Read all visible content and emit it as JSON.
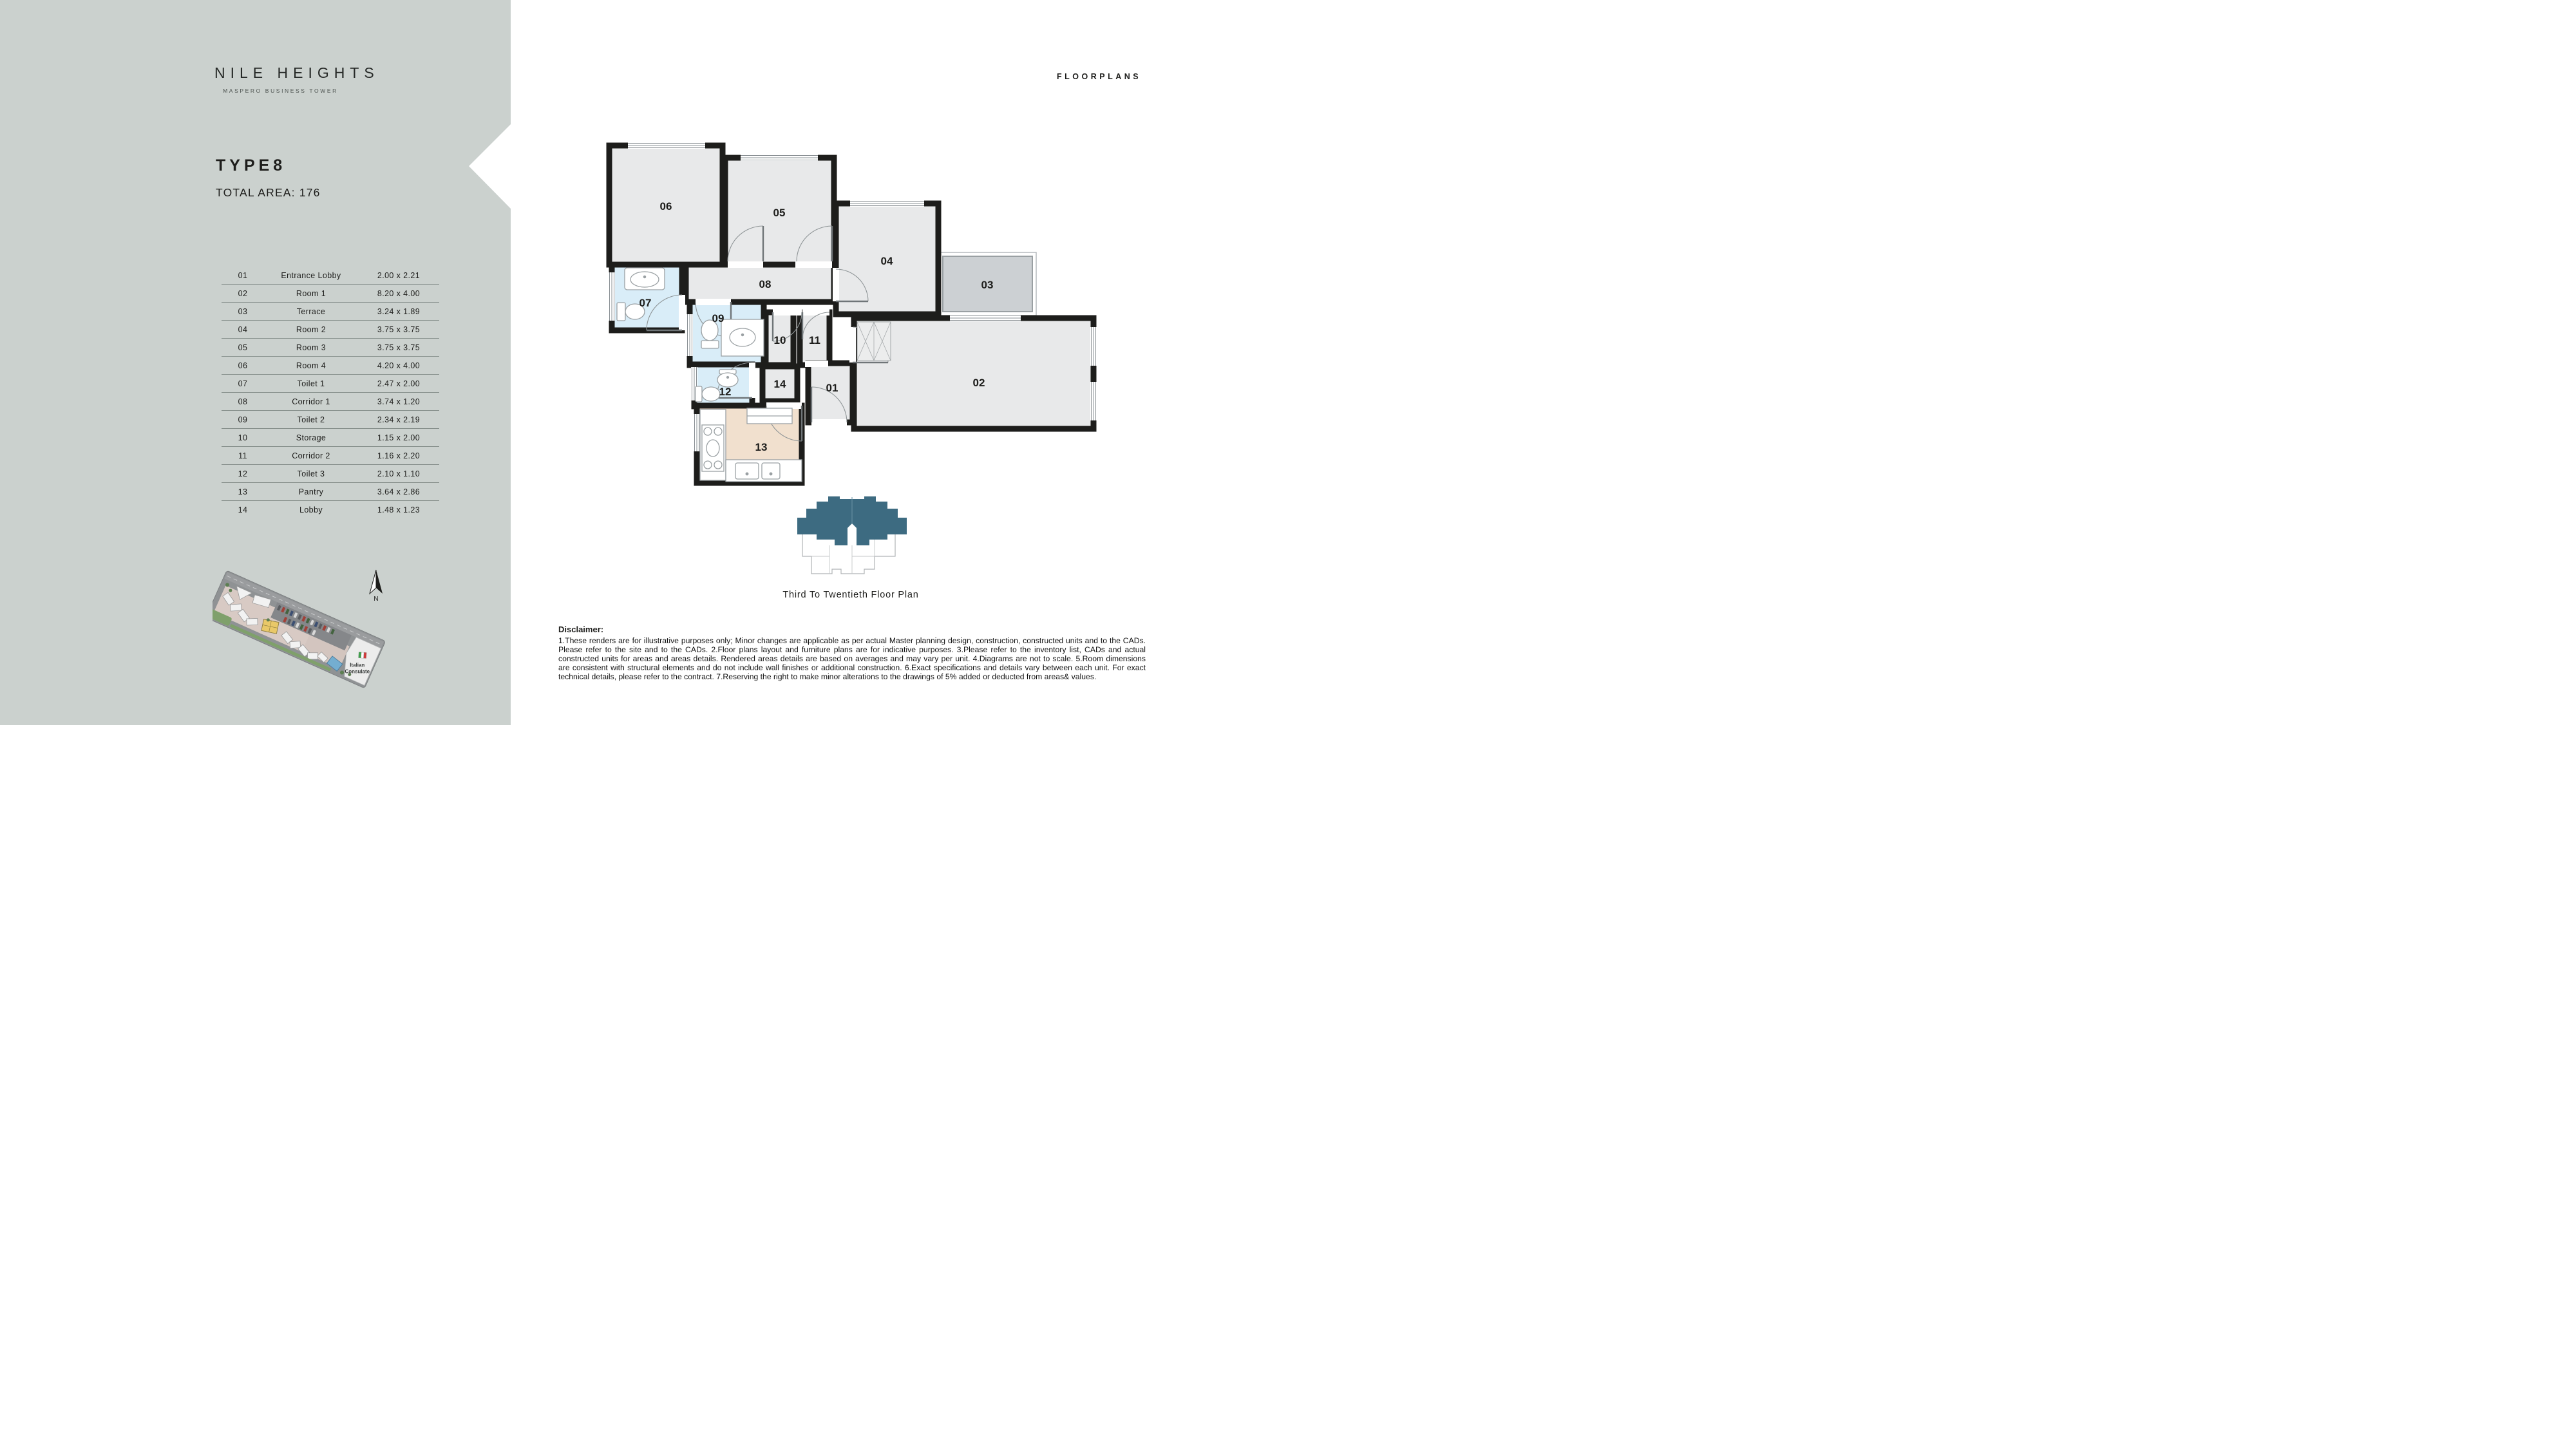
{
  "brand": {
    "title": "NILE HEIGHTS",
    "subtitle": "MASPERO BUSINESS TOWER"
  },
  "unit": {
    "type": "TYPE8",
    "total_area": "TOTAL AREA: 176"
  },
  "header": {
    "title": "FLOORPLANS"
  },
  "legend": {
    "rooms": [
      {
        "no": "01",
        "name": "Entrance Lobby",
        "dims": "2.00 x 2.21"
      },
      {
        "no": "02",
        "name": "Room 1",
        "dims": "8.20 x 4.00"
      },
      {
        "no": "03",
        "name": "Terrace",
        "dims": "3.24 x 1.89"
      },
      {
        "no": "04",
        "name": "Room 2",
        "dims": "3.75 x 3.75"
      },
      {
        "no": "05",
        "name": "Room 3",
        "dims": "3.75 x 3.75"
      },
      {
        "no": "06",
        "name": "Room 4",
        "dims": "4.20 x 4.00"
      },
      {
        "no": "07",
        "name": "Toilet 1",
        "dims": "2.47 x 2.00"
      },
      {
        "no": "08",
        "name": "Corridor 1",
        "dims": "3.74 x 1.20"
      },
      {
        "no": "09",
        "name": "Toilet 2",
        "dims": "2.34 x 2.19"
      },
      {
        "no": "10",
        "name": "Storage",
        "dims": "1.15 x 2.00"
      },
      {
        "no": "11",
        "name": "Corridor 2",
        "dims": "1.16 x 2.20"
      },
      {
        "no": "12",
        "name": "Toilet 3",
        "dims": "2.10 x 1.10"
      },
      {
        "no": "13",
        "name": "Pantry",
        "dims": "3.64 x 2.86"
      },
      {
        "no": "14",
        "name": "Lobby",
        "dims": "1.48 x 1.23"
      }
    ]
  },
  "plan": {
    "labels": {
      "r01": "01",
      "r02": "02",
      "r03": "03",
      "r04": "04",
      "r05": "05",
      "r06": "06",
      "r07": "07",
      "r08": "08",
      "r09": "09",
      "r10": "10",
      "r11": "11",
      "r12": "12",
      "r13": "13",
      "r14": "14"
    }
  },
  "key_plan": {
    "caption": "Third To Twentieth Floor Plan"
  },
  "site_map": {
    "consulate_label": "Italian Consulate",
    "consulate_lines": [
      "Italian",
      "Consulate"
    ],
    "north_label": "N"
  },
  "disclaimer": {
    "title": "Disclaimer:",
    "body": "1.These renders are for illustrative purposes only; Minor changes are applicable as per actual Master planning design, construction, constructed units and to the CADs. Please refer to the site and to the CADs. 2.Floor plans layout and furniture plans are for indicative purposes. 3.Please refer to the inventory list, CADs and actual constructed units for areas and areas details. Rendered areas details are based on averages and may vary per unit. 4.Diagrams are not to scale. 5.Room dimensions are consistent with structural elements and do not include wall finishes or additional construction. 6.Exact specifications and details vary between each unit. For exact technical details, please refer to the contract. 7.Reserving the right to make minor alterations to the drawings of 5% added or deducted from areas& values."
  },
  "colors": {
    "sidebar": "#cbd1ce",
    "wall": "#1d1d1b",
    "room": "#e8e9ea",
    "toilet": "#d9edf8",
    "pantry": "#f1e0ce",
    "terrace": "#ccd0d3",
    "key_plan_teal": "#3d6b81"
  }
}
